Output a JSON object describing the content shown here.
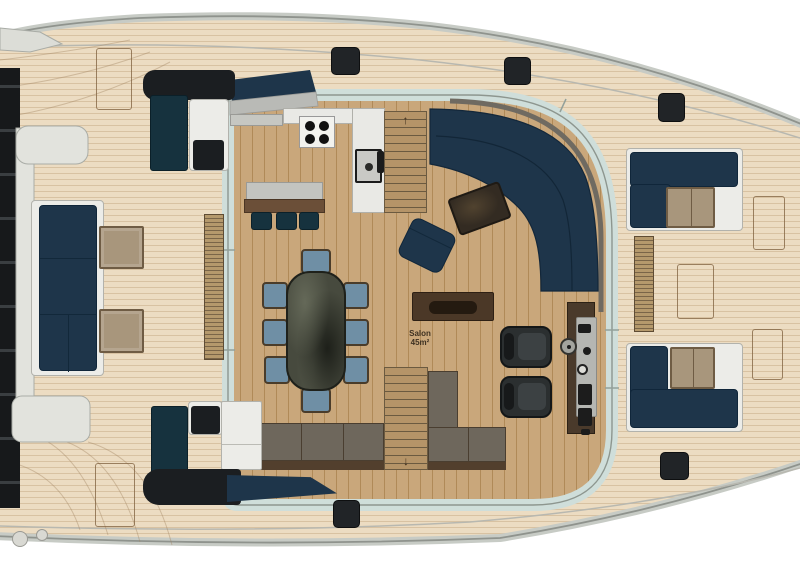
{
  "plan": {
    "salon_label": {
      "name": "Salon",
      "area": "45m²"
    },
    "stairs_up_arrow": "↑",
    "stairs_down_arrow": "↓"
  },
  "palette": {
    "deck_wood": "#ecdcc2",
    "deck_line": "#d8c2a2",
    "salon_wood": "#c9a77b",
    "salon_line": "#b08a58",
    "navy": "#1e354a",
    "dark_teal": "#16323e",
    "black_pad": "#1b1e21",
    "gunwale": "#c7cbc5",
    "hull_line": "#8f938d",
    "window_band": "#cfdeda",
    "cushion_gray": "#6e675c",
    "cushion_frame": "#4a3e30",
    "table_dark": "#474a3e",
    "chair_seat": "#6f8fa5",
    "counter_white": "#e9e9e5",
    "counter_gray": "#c6c7c2",
    "tan_table": "#a8967c",
    "stair_wood": "#b59468",
    "wood_brown": "#6b4f38"
  }
}
